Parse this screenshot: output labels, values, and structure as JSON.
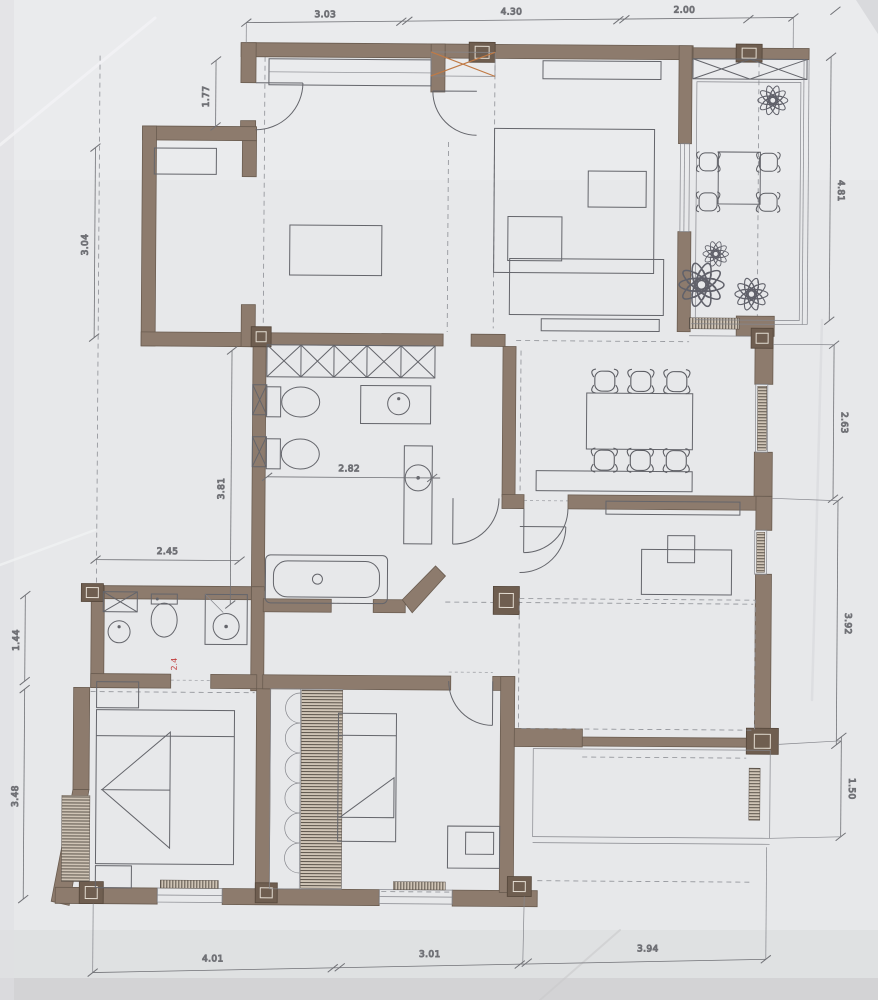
{
  "plan": {
    "dims": {
      "top": [
        "3.03",
        "4.30",
        "2.00"
      ],
      "bottom": [
        "4.01",
        "3.01",
        "3.94"
      ],
      "left_wall_upper": "1.77",
      "left_bay": "3.04",
      "bath_height": "3.81",
      "bath_width": "2.82",
      "wc_width": "2.45",
      "wc_height": "1.44",
      "bedroom_left": "3.48",
      "terrace_right": "4.81",
      "dining_right": "2.63",
      "bedroom_right": "3.92",
      "balcony_right": "1.50",
      "red_note": "2.4"
    },
    "colors": {
      "paper": "#e7e8ea",
      "wall": "#8d7b6d",
      "wall_edge": "#6a5c50",
      "line": "#64656b",
      "dashed": "#8d8f95",
      "dim_text": "#54555a",
      "accent_orange": "#c07a45",
      "accent_red": "#c13b3b"
    }
  }
}
